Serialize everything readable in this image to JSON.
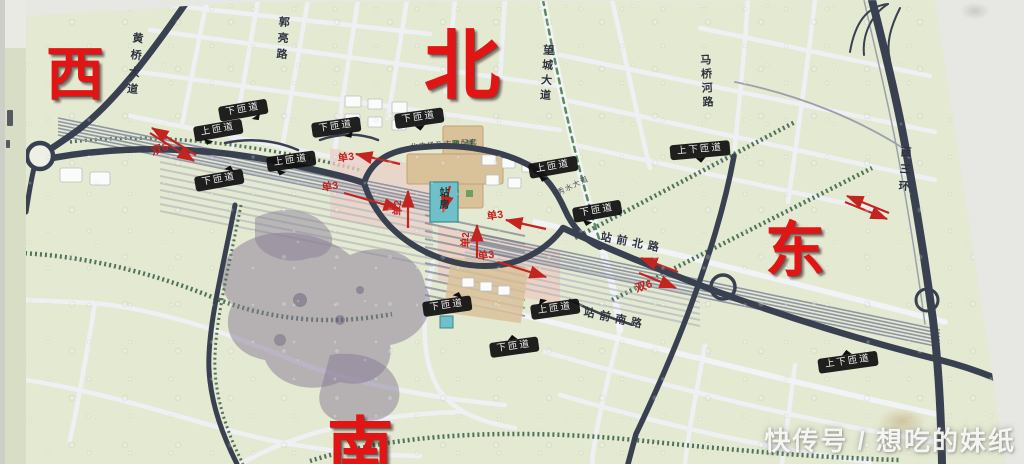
{
  "compass": {
    "west": "西",
    "north": "北",
    "east": "东",
    "south": "南"
  },
  "road_names": {
    "huangqiao_avenue": "黄桥大道",
    "guoliang_road": "郭亮路",
    "wangcheng_avenue": "望城大道",
    "maqiaohe_road": "马桥河路",
    "xisanhuan_road": "西三环",
    "zhanqian_north_road": "站前北路",
    "zhanqian_south_road": "站前南路",
    "xiushui_avenue": "秀水大道"
  },
  "station": {
    "building": "站房",
    "north_plaza": "北广场及市政配套"
  },
  "ramp_labels": [
    "下匝道",
    "上匝道",
    "下匝道",
    "下匝道",
    "上匝道",
    "下匝道",
    "上匝道",
    "上下匝道",
    "下匝道",
    "下匝道",
    "上匝道",
    "下匝道",
    "上下匝道"
  ],
  "lane_labels": {
    "dual_west": "双6",
    "dual_east": "双6",
    "single3_nw": "单3",
    "single3_sw": "单3",
    "single3_ne": "单3",
    "single3_se": "单3",
    "single2_left": "单2",
    "single2_right": "单2"
  },
  "watermark": "快传号 / 想吃的妹纸",
  "colors": {
    "compass_red": "#e31414",
    "lane_red": "#c3241f",
    "map_green": "#e4e9d2",
    "road_dark": "#394050",
    "label_black": "#141414",
    "station_teal": "#6fc0c8",
    "plaza_tan": "#d9c29a"
  }
}
